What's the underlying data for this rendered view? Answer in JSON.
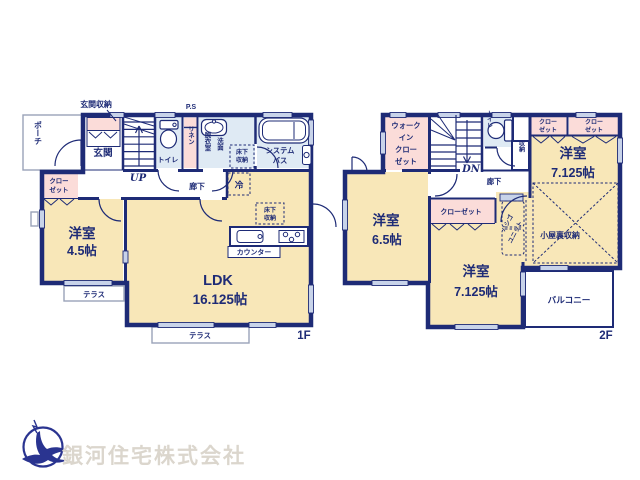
{
  "colors": {
    "wall_navy": "#1e2b76",
    "room_cream": "#f8e7b8",
    "closet_pink": "#fbdcd9",
    "wet_blue": "#dfeaf4",
    "window_blue": "#c8d3e9",
    "outline_gray": "#9aa3b8",
    "logo_navy": "#2a3490",
    "logo_text_gray": "#dbd6cd"
  },
  "floor1": {
    "floor_label": "1F",
    "porch": "ポーチ",
    "entrance_storage": "玄関収納",
    "ps": "P.S",
    "entrance": "玄関",
    "up": "UP",
    "toilet": "トイレ",
    "linen": "リネン",
    "dressing_room": "脱衣室",
    "washstand": "洗面",
    "underfloor_storage1_l1": "床下",
    "underfloor_storage1_l2": "収納",
    "system_bath_l1": "システム",
    "system_bath_l2": "バス",
    "hallway": "廊下",
    "fridge": "冷",
    "closet_l1": "クロー",
    "closet_l2": "ゼット",
    "room45_name": "洋室",
    "room45_size": "4.5帖",
    "terrace1": "テラス",
    "ldk_name": "LDK",
    "ldk_size": "16.125帖",
    "underfloor_storage2_l1": "床下",
    "underfloor_storage2_l2": "収納",
    "counter": "カウンター",
    "terrace2": "テラス"
  },
  "floor2": {
    "floor_label": "2F",
    "wic_l1": "ウォーク",
    "wic_l2": "イン",
    "wic_l3": "クロー",
    "wic_l4": "ゼット",
    "dn": "DN",
    "toilet": "トイレ",
    "storage": "収納",
    "closet_a_l1": "クロー",
    "closet_a_l2": "ゼット",
    "closet_b_l1": "クロー",
    "closet_b_l2": "ゼット",
    "room_tr_name": "洋室",
    "room_tr_size": "7.125帖",
    "hallway": "廊下",
    "closet_mid": "クローゼット",
    "ladder_l1": "ハシゴ",
    "ladder_l2": "ユニット",
    "attic_storage": "小屋裏収納",
    "room_bm_name": "洋室",
    "room_bm_size": "7.125帖",
    "room_l_name": "洋室",
    "room_l_size": "6.5帖",
    "balcony": "バルコニー"
  },
  "logo": {
    "company": "銀河住宅株式会社"
  }
}
